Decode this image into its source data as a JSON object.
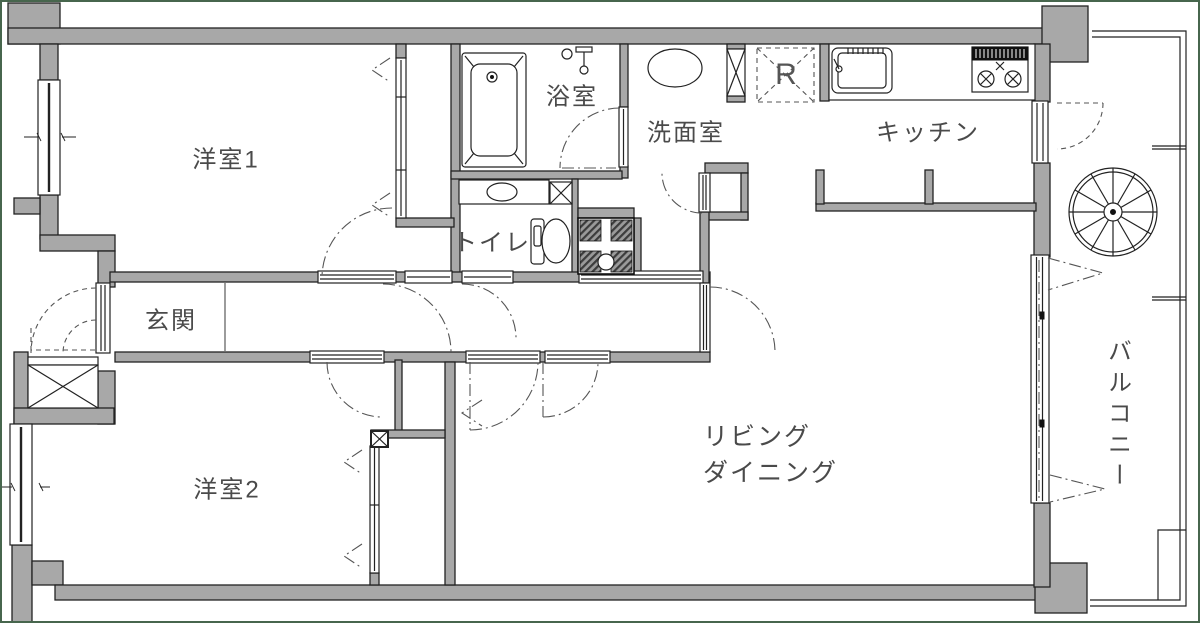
{
  "floor_plan": {
    "labels": {
      "room1": "洋室1",
      "bathroom": "浴室",
      "washroom": "洗面室",
      "kitchen": "キッチン",
      "refrigerator": "R",
      "toilet": "トイレ",
      "entrance": "玄関",
      "room2": "洋室2",
      "living_dining_line1": "リビング",
      "living_dining_line2": "ダイニング",
      "balcony": "バルコニー"
    },
    "colors": {
      "wall": "#a8a8a8",
      "line": "#222222",
      "label": "#4a4a4a",
      "border": "#47664d",
      "background": "#ffffff"
    }
  }
}
